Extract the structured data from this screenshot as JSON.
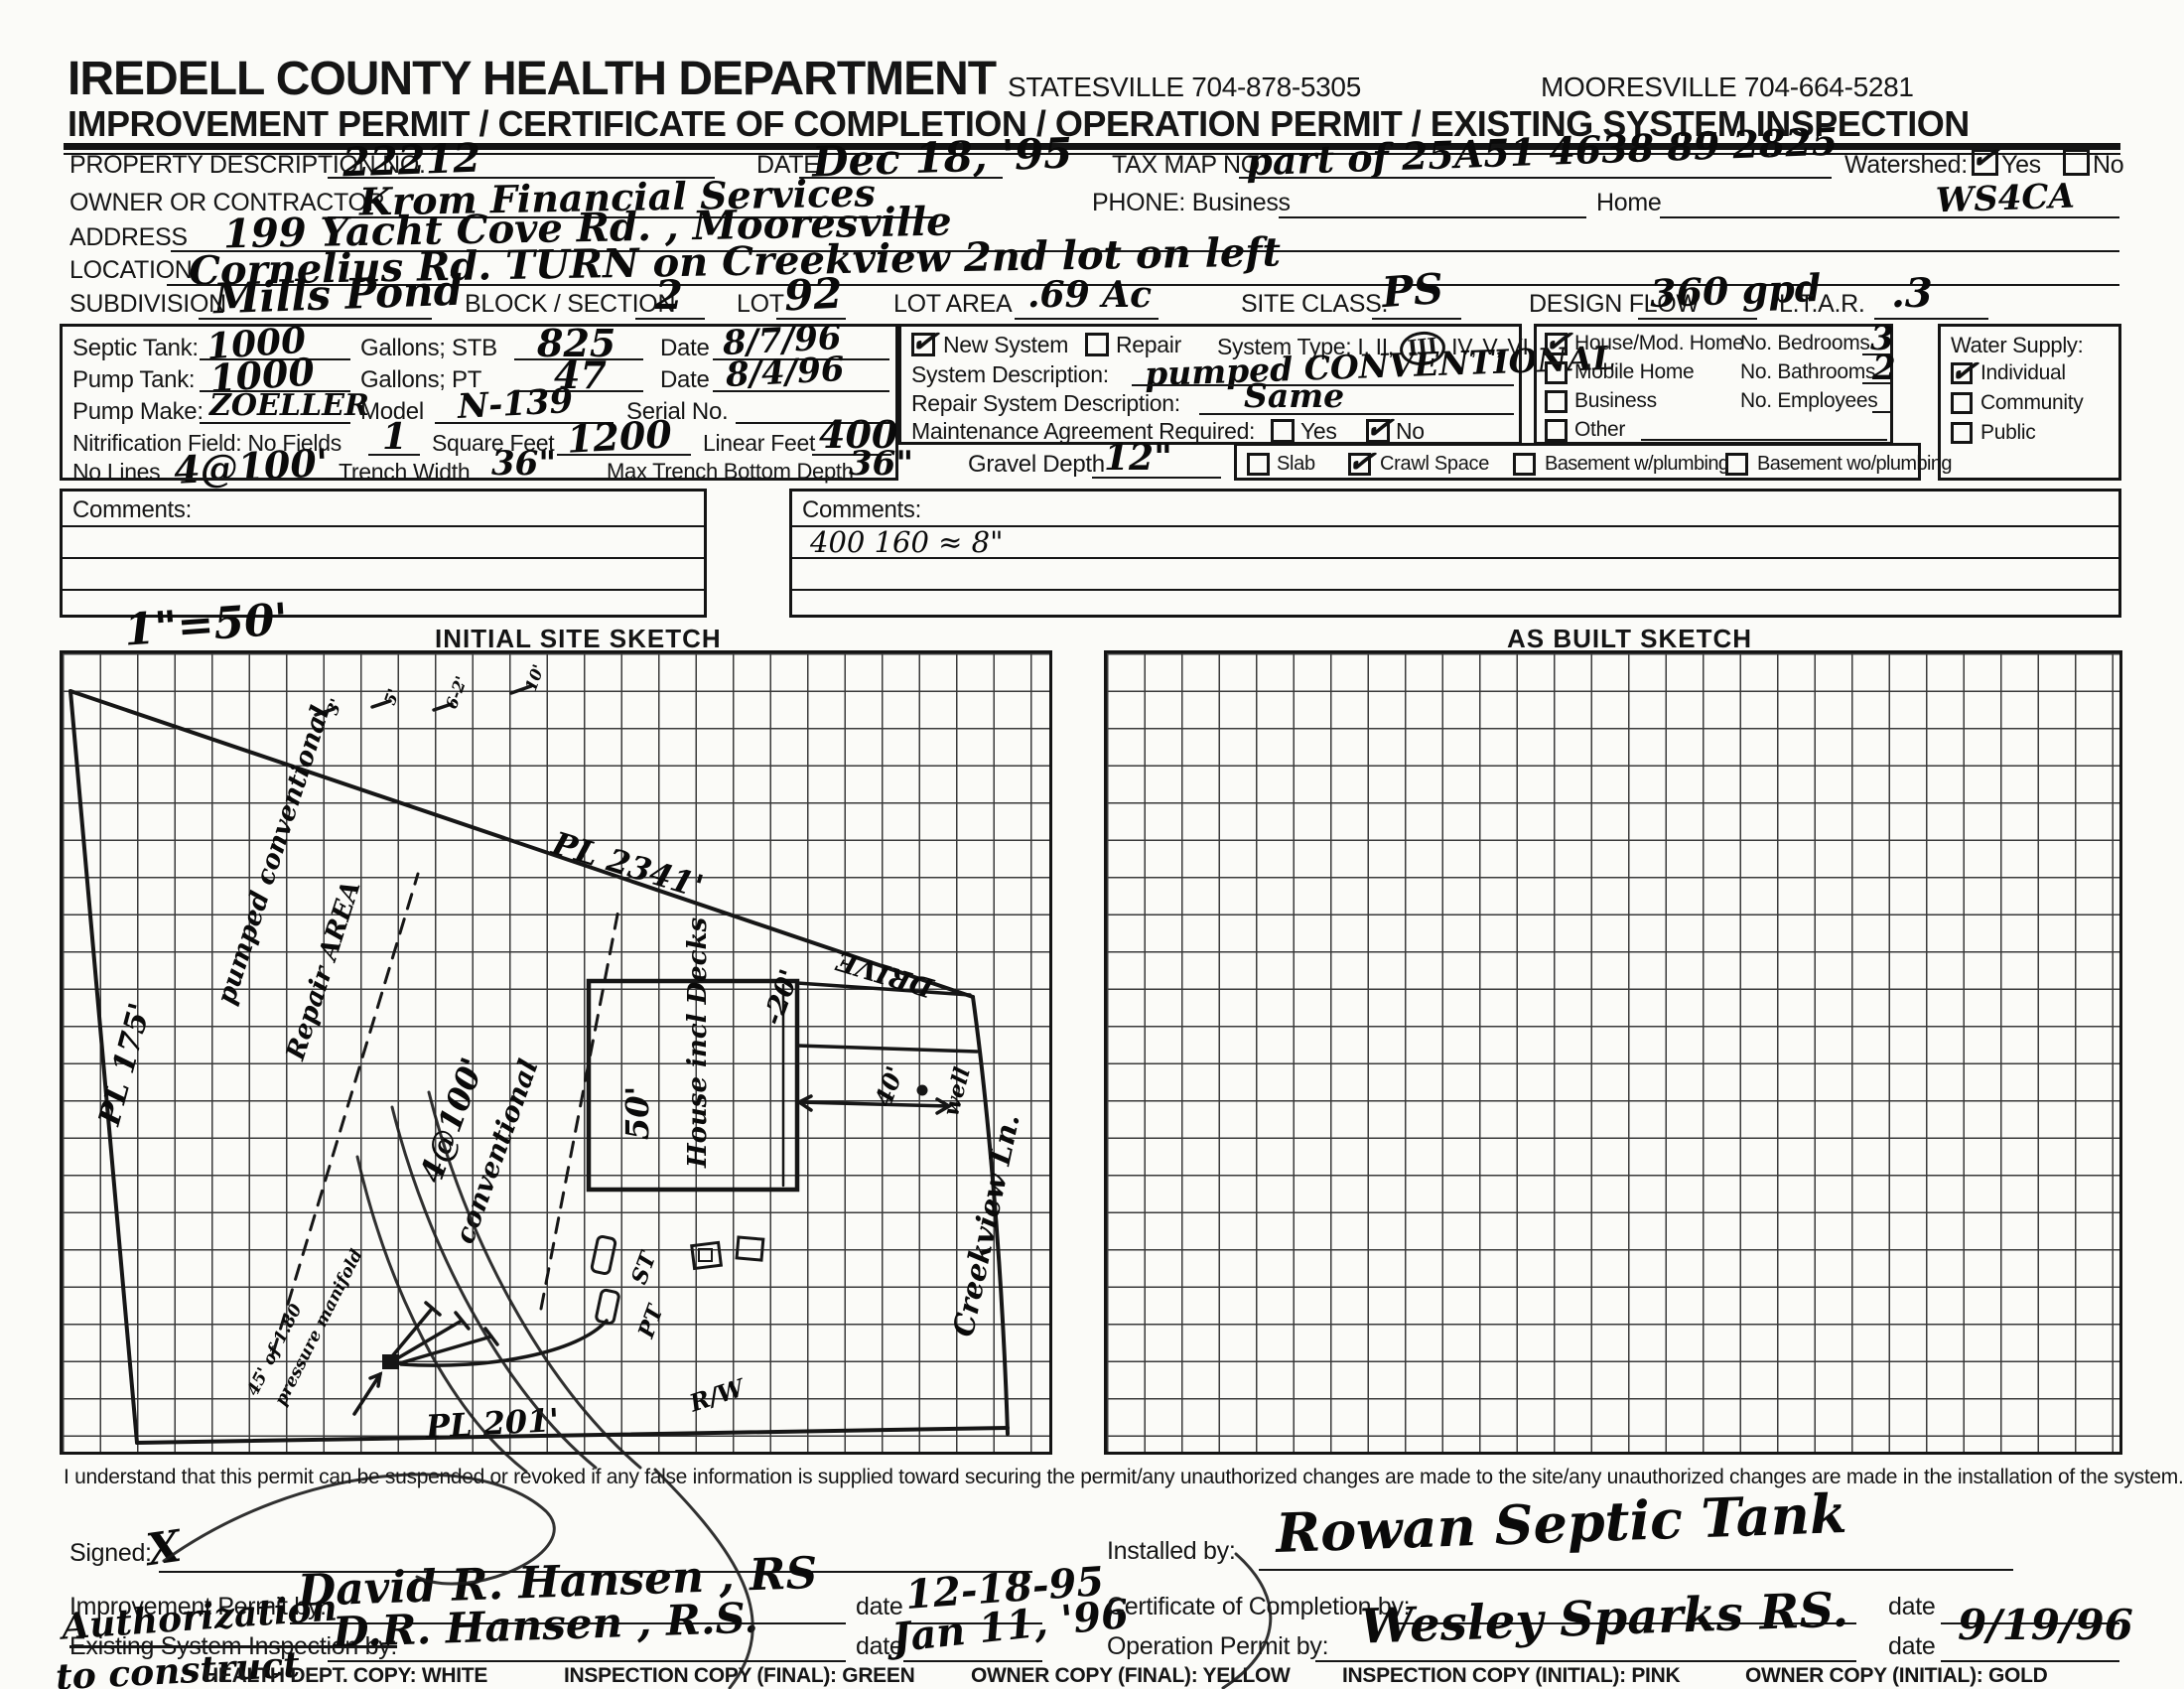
{
  "header": {
    "title": "IREDELL COUNTY HEALTH DEPARTMENT",
    "statesville": "STATESVILLE 704-878-5305",
    "mooresville": "MOORESVILLE 704-664-5281",
    "subtitle": "IMPROVEMENT PERMIT / CERTIFICATE OF COMPLETION / OPERATION PERMIT / EXISTING SYSTEM INSPECTION"
  },
  "fields": {
    "property_label": "PROPERTY DESCRIPTION NO.",
    "property_value": "22212",
    "date_label": "DATE",
    "date_value": "Dec 18, '95",
    "taxmap_label": "TAX MAP NO.",
    "taxmap_value": "part of 25A51  4638 89 2825",
    "watershed_label": "Watershed:",
    "yes": "Yes",
    "no": "No",
    "watershed_code": "WS4CA",
    "owner_label": "OWNER OR CONTRACTOR",
    "owner_value": "Krom Financial Services",
    "phone_label": "PHONE: Business",
    "home_label": "Home",
    "address_label": "ADDRESS",
    "address_value": "199 Yacht Cove Rd. ,  Mooresville",
    "location_label": "LOCATION",
    "location_value": "Cornelius Rd.   TURN on Creekview   2nd lot on left",
    "subdivision_label": "SUBDIVISION",
    "subdivision_value": "Mills Pond",
    "block_label": "BLOCK / SECTION",
    "block_value": "2",
    "lot_label": "LOT",
    "lot_value": "92",
    "lot_area_label": "LOT AREA",
    "lot_area_value": ".69 Ac",
    "site_class_label": "SITE CLASS.",
    "site_class_value": "PS",
    "design_flow_label": "DESIGN FLOW",
    "design_flow_value": "360 gpd",
    "ltar_label": "L.T.A.R.",
    "ltar_value": ".3"
  },
  "tank_box": {
    "septic_label": "Septic Tank:",
    "septic_value": "1000",
    "gallons_stb": "Gallons;  STB",
    "stb_value": "825",
    "date_label": "Date",
    "stb_date": "8/7/96",
    "pump_label": "Pump Tank:",
    "pump_value": "1000",
    "gallons_pt": "Gallons;  PT",
    "pt_value": "47",
    "pt_date": "8/4/96",
    "make_label": "Pump Make:",
    "make_value": "ZOELLER",
    "model_label": "Model",
    "model_value": "N-139",
    "serial_label": "Serial No.",
    "nit_label": "Nitrification Field: No Fields",
    "nit_value": "1",
    "sqft_label": "Square Feet",
    "sqft_value": "1200",
    "linft_label": "Linear Feet",
    "linft_value": "400",
    "lines_label": "No Lines",
    "lines_value": "4@100'",
    "trench_label": "Trench Width",
    "trench_value": "36\"",
    "depth_label": "Max Trench Bottom Depth",
    "depth_value": "36\""
  },
  "system_box": {
    "new_system": "New System",
    "repair": "Repair",
    "type_prefix": "System Type: I, II,",
    "type_circled": "III",
    "type_suffix": "IV, V, VI",
    "sysdesc_label": "System Description:",
    "sysdesc_value": "pumped CONVENTIONAL",
    "repairdesc_label": "Repair System Description:",
    "repairdesc_value": "Same",
    "maint_label": "Maintenance Agreement Required:",
    "yes": "Yes",
    "no": "No"
  },
  "gravel": {
    "label": "Gravel Depth",
    "value": "12\""
  },
  "foundation": {
    "slab": "Slab",
    "crawl": "Crawl Space",
    "basement_w": "Basement w/plumbing",
    "basement_wo": "Basement wo/plumbing"
  },
  "structure_box": {
    "house": "House/Mod. Home",
    "mobile": "Mobile Home",
    "business": "Business",
    "other": "Other",
    "bedrooms_label": "No. Bedrooms",
    "bedrooms_value": "3",
    "bathrooms_label": "No. Bathrooms",
    "bathrooms_value": "2",
    "employees_label": "No. Employees"
  },
  "water_box": {
    "title": "Water Supply:",
    "individual": "Individual",
    "community": "Community",
    "public": "Public"
  },
  "comments": {
    "left_label": "Comments:",
    "right_label": "Comments:",
    "right_line1": "400      160 ≈ 8\""
  },
  "sketch": {
    "scale": "1\"=50'",
    "left_title": "INITIAL SITE SKETCH",
    "right_title": "AS BUILT SKETCH",
    "labels": {
      "pl_top": "PL 2341'",
      "pl_left": "PL 175'",
      "pl_bottom": "PL 201'",
      "pumped": "pumped conventional",
      "repair_area": "Repair AREA",
      "lines4": "4@100'",
      "conventional": "conventional",
      "manifold1": "45' of 1.80",
      "manifold2": "pressure manifold",
      "house_w": "50'",
      "house": "House incl Decks",
      "drive": "DRIVE",
      "well": "well",
      "forty": "40'",
      "twenty": "-20'",
      "creekview": "Creekview Ln.",
      "st": "ST",
      "pt": "PT",
      "rw": "R/W",
      "m3": "3'",
      "m5": "5'",
      "m62": "6-2'",
      "m10": "10'"
    }
  },
  "statement": "I understand that this permit can be suspended or revoked if any false information is supplied toward securing the permit/any unauthorized changes are made to the site/any unauthorized changes are made in the installation of the system.",
  "signatures": {
    "signed_label": "Signed:",
    "signed_x": "X",
    "improvement_label": "Improvement Permit by:",
    "improvement_name": "David R. Hansen  , RS",
    "date_label": "date",
    "improvement_date": "12-18-95",
    "existing_label": "Existing System Inspection by:",
    "authorization": "Authorization",
    "to_construct": "to construct",
    "existing_name": "D.R. Hansen   , R.S.",
    "existing_date": "Jan 11, '96",
    "installed_label": "Installed by:",
    "installed_name": "Rowan Septic Tank",
    "cert_label": "Certificate of Completion by:",
    "operation_label": "Operation Permit by:",
    "operation_name": "Wesley Sparks RS.",
    "operation_date": "9/19/96"
  },
  "footer": {
    "c1": "HEALTH DEPT. COPY: WHITE",
    "c2": "INSPECTION COPY (FINAL): GREEN",
    "c3": "OWNER COPY (FINAL): YELLOW",
    "c4": "INSPECTION COPY (INITIAL): PINK",
    "c5": "OWNER COPY (INITIAL): GOLD"
  }
}
